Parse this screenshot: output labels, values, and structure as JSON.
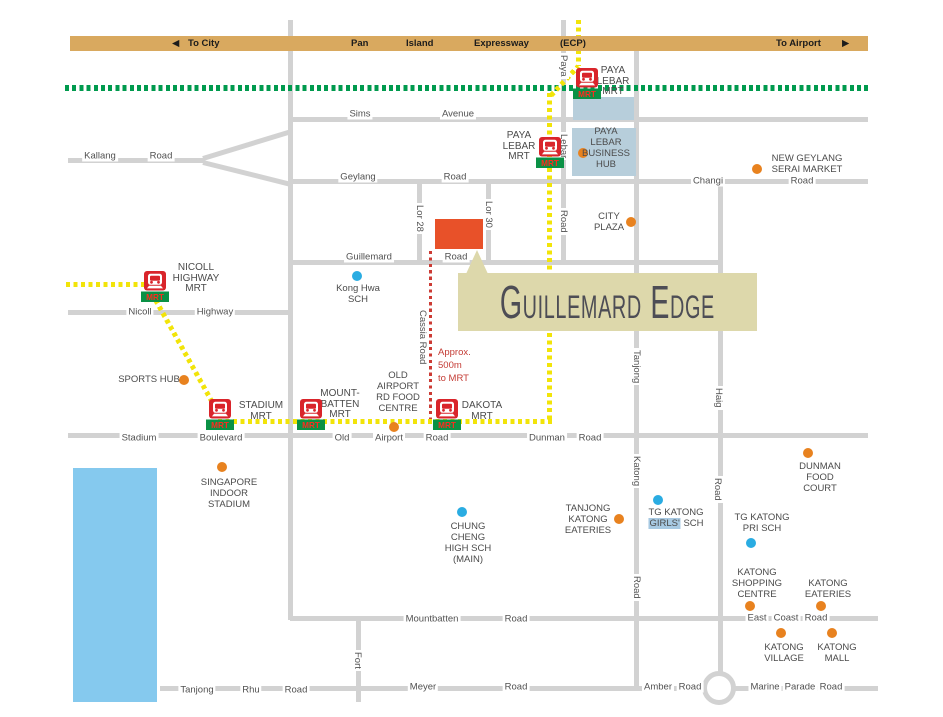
{
  "colors": {
    "road": "#d2d2d2",
    "band": "#d9a95f",
    "green_line": "#009a4e",
    "yellow_line": "#f2e409",
    "red_line": "#cc3b34",
    "amenity_dot": "#e8821f",
    "school_dot": "#2aace2",
    "site": "#e85129",
    "title_bg": "#ddd8ab",
    "title_text": "#4d4d55",
    "hub_block": "#b7cedb",
    "water": "#85c9ee",
    "highlight": "#a7c9e2",
    "mrt_red": "#d9252b",
    "mrt_green": "#0a9145"
  },
  "band": {
    "to_city_arrow": "◀",
    "to_city": "To City",
    "pan": "Pan",
    "island": "Island",
    "expressway": "Expressway",
    "ecp": "(ECP)",
    "to_airport": "To Airport",
    "to_airport_arrow": "▶"
  },
  "title_box": {
    "label": "Guillemard Edge"
  },
  "walk_note": {
    "lines": [
      "Approx.",
      "500m",
      "to MRT"
    ]
  },
  "roads": [
    {
      "name": "sims-avenue",
      "type": "h",
      "x": 292,
      "y": 119,
      "len": 576
    },
    {
      "name": "kallang-road",
      "type": "h",
      "x": 68,
      "y": 160,
      "len": 137
    },
    {
      "name": "geylang-changi-road",
      "type": "h",
      "x": 289,
      "y": 181,
      "len": 579
    },
    {
      "name": "guillemard-road",
      "type": "h",
      "x": 292,
      "y": 262,
      "len": 430
    },
    {
      "name": "nicoll-highway",
      "type": "h",
      "x": 68,
      "y": 312,
      "len": 224
    },
    {
      "name": "stadium-old-airport-dunman-road",
      "type": "h",
      "x": 68,
      "y": 435,
      "len": 800
    },
    {
      "name": "mountbatten-east-coast-road",
      "type": "h",
      "x": 290,
      "y": 618,
      "len": 588
    },
    {
      "name": "meyer-amber-marine-parade-road",
      "type": "h",
      "x": 160,
      "y": 688,
      "len": 718
    },
    {
      "name": "aljunied-road",
      "type": "v",
      "x": 290,
      "y": 20,
      "len": 600
    },
    {
      "name": "fort-road",
      "type": "v",
      "x": 358,
      "y": 618,
      "len": 84
    },
    {
      "name": "lorong-28",
      "type": "v",
      "x": 419,
      "y": 181,
      "len": 83
    },
    {
      "name": "lorong-30",
      "type": "v",
      "x": 488,
      "y": 181,
      "len": 83
    },
    {
      "name": "paya-lebar-road",
      "type": "v",
      "x": 563,
      "y": 20,
      "len": 244
    },
    {
      "name": "tanjong-katong-road",
      "type": "v",
      "x": 636,
      "y": 50,
      "len": 640
    },
    {
      "name": "haig-road",
      "type": "v",
      "x": 720,
      "y": 181,
      "len": 509
    },
    {
      "name": "kallang-fork-upper",
      "type": "d",
      "x": 203,
      "y": 158,
      "len": 92,
      "angle": -17
    },
    {
      "name": "kallang-fork-lower",
      "type": "d",
      "x": 203,
      "y": 162,
      "len": 90,
      "angle": 14
    }
  ],
  "transit": [
    {
      "name": "mrt-east-west-line",
      "color": "green",
      "type": "h",
      "x": 65,
      "y": 87,
      "len": 803
    },
    {
      "name": "mrt-circle-line-west",
      "color": "yellow",
      "type": "h",
      "x": 66,
      "y": 284,
      "len": 82
    },
    {
      "name": "mrt-circle-line-nicoll-stadium",
      "color": "yellow",
      "type": "d",
      "x": 152,
      "y": 293,
      "len": 130,
      "angle": 61
    },
    {
      "name": "mrt-circle-line-south",
      "color": "yellow",
      "type": "h",
      "x": 218,
      "y": 421,
      "len": 336
    },
    {
      "name": "mrt-line-paya-lebar-vertical",
      "color": "yellow",
      "type": "v",
      "x": 549,
      "y": 93,
      "len": 330
    },
    {
      "name": "mrt-line-paya-lebar-diagonal",
      "color": "yellow",
      "type": "d",
      "x": 551,
      "y": 95,
      "len": 40,
      "angle": -47
    },
    {
      "name": "mrt-line-top",
      "color": "yellow",
      "type": "v",
      "x": 578,
      "y": 20,
      "len": 46
    },
    {
      "name": "walking-route-cassia",
      "color": "red",
      "type": "v",
      "x": 431,
      "y": 251,
      "len": 168
    }
  ],
  "areas": [
    {
      "kind": "water",
      "name": "kallang-basin-water",
      "x": 73,
      "y": 468,
      "w": 84,
      "h": 234
    },
    {
      "kind": "hub",
      "name": "paya-lebar-business-hub-block-upper",
      "x": 573,
      "y": 97,
      "w": 61,
      "h": 23
    },
    {
      "kind": "hub",
      "name": "paya-lebar-business-hub-block-lower",
      "x": 572,
      "y": 128,
      "w": 64,
      "h": 48
    },
    {
      "kind": "site",
      "name": "guillemard-edge-site",
      "x": 435,
      "y": 219,
      "w": 48,
      "h": 30
    },
    {
      "kind": "roundabout",
      "name": "marine-parade-roundabout",
      "x": 702,
      "y": 671,
      "w": 34,
      "h": 34
    }
  ],
  "road_labels": [
    {
      "t": "Sims",
      "x": 360,
      "y": 114
    },
    {
      "t": "Avenue",
      "x": 458,
      "y": 114
    },
    {
      "t": "Kallang",
      "x": 100,
      "y": 156
    },
    {
      "t": "Road",
      "x": 161,
      "y": 156
    },
    {
      "t": "Geylang",
      "x": 358,
      "y": 177
    },
    {
      "t": "Road",
      "x": 455,
      "y": 177
    },
    {
      "t": "Changi",
      "x": 708,
      "y": 181
    },
    {
      "t": "Road",
      "x": 802,
      "y": 181
    },
    {
      "t": "Guillemard",
      "x": 369,
      "y": 257
    },
    {
      "t": "Road",
      "x": 456,
      "y": 257
    },
    {
      "t": "Nicoll",
      "x": 140,
      "y": 312
    },
    {
      "t": "Highway",
      "x": 215,
      "y": 312
    },
    {
      "t": "Stadium",
      "x": 139,
      "y": 438
    },
    {
      "t": "Boulevard",
      "x": 221,
      "y": 438
    },
    {
      "t": "Old",
      "x": 342,
      "y": 438
    },
    {
      "t": "Airport",
      "x": 389,
      "y": 438
    },
    {
      "t": "Road",
      "x": 437,
      "y": 438
    },
    {
      "t": "Dunman",
      "x": 547,
      "y": 438
    },
    {
      "t": "Road",
      "x": 590,
      "y": 438
    },
    {
      "t": "Mountbatten",
      "x": 432,
      "y": 619
    },
    {
      "t": "Road",
      "x": 516,
      "y": 619
    },
    {
      "t": "East",
      "x": 757,
      "y": 618
    },
    {
      "t": "Coast",
      "x": 786,
      "y": 618
    },
    {
      "t": "Road",
      "x": 816,
      "y": 618
    },
    {
      "t": "Meyer",
      "x": 423,
      "y": 687
    },
    {
      "t": "Road",
      "x": 516,
      "y": 687
    },
    {
      "t": "Tanjong",
      "x": 197,
      "y": 690
    },
    {
      "t": "Rhu",
      "x": 251,
      "y": 690
    },
    {
      "t": "Road",
      "x": 296,
      "y": 690
    },
    {
      "t": "Amber",
      "x": 658,
      "y": 687
    },
    {
      "t": "Road",
      "x": 690,
      "y": 687
    },
    {
      "t": "Marine",
      "x": 765,
      "y": 687
    },
    {
      "t": "Parade",
      "x": 800,
      "y": 687
    },
    {
      "t": "Road",
      "x": 831,
      "y": 687
    }
  ],
  "vertical_labels": [
    {
      "t": "Paya",
      "x": 558,
      "y": 53
    },
    {
      "t": "Lebar",
      "x": 558,
      "y": 132
    },
    {
      "t": "Road",
      "x": 558,
      "y": 208
    },
    {
      "t": "Lor 28",
      "x": 414,
      "y": 203
    },
    {
      "t": "Lor 30",
      "x": 483,
      "y": 199
    },
    {
      "t": "Cassia Road",
      "x": 417,
      "y": 308
    },
    {
      "t": "Tanjong",
      "x": 631,
      "y": 348
    },
    {
      "t": "Katong",
      "x": 631,
      "y": 454
    },
    {
      "t": "Road",
      "x": 631,
      "y": 574
    },
    {
      "t": "Haig",
      "x": 713,
      "y": 386
    },
    {
      "t": "Road",
      "x": 712,
      "y": 476
    },
    {
      "t": "Fort",
      "x": 352,
      "y": 650
    }
  ],
  "stations": [
    {
      "name": "paya-lebar-mrt-interchange",
      "icon_x": 587,
      "icon_y": 68,
      "label_x": 613,
      "label_y": 66,
      "lines": [
        "PAYA",
        "LEBAR",
        "MRT"
      ]
    },
    {
      "name": "paya-lebar-mrt",
      "icon_x": 550,
      "icon_y": 137,
      "label_x": 519,
      "label_y": 131,
      "lines": [
        "PAYA",
        "LEBAR",
        "MRT"
      ]
    },
    {
      "name": "nicoll-highway-mrt",
      "icon_x": 155,
      "icon_y": 271,
      "label_x": 196,
      "label_y": 263,
      "lines": [
        "NICOLL",
        "HIGHWAY",
        "MRT"
      ]
    },
    {
      "name": "stadium-mrt",
      "icon_x": 220,
      "icon_y": 399,
      "label_x": 261,
      "label_y": 401,
      "lines": [
        "STADIUM",
        "MRT"
      ]
    },
    {
      "name": "mountbatten-mrt",
      "icon_x": 311,
      "icon_y": 399,
      "label_x": 340,
      "label_y": 389,
      "lines": [
        "MOUNT-",
        "BATTEN",
        "MRT"
      ]
    },
    {
      "name": "dakota-mrt",
      "icon_x": 447,
      "icon_y": 399,
      "label_x": 482,
      "label_y": 401,
      "lines": [
        "DAKOTA",
        "MRT"
      ]
    }
  ],
  "pois": [
    {
      "kind": "amenity",
      "name": "sports-hub",
      "dot_x": 184,
      "dot_y": 380,
      "label_x": 149,
      "label_y": 374,
      "lines": [
        "SPORTS HUB"
      ]
    },
    {
      "kind": "amenity",
      "name": "old-airport-rd-food-centre",
      "dot_x": 394,
      "dot_y": 427,
      "label_x": 398,
      "label_y": 370,
      "lines": [
        "OLD",
        "AIRPORT",
        "RD FOOD",
        "CENTRE"
      ]
    },
    {
      "kind": "amenity",
      "name": "paya-lebar-business-hub",
      "dot_x": 583,
      "dot_y": 153,
      "label_x": 606,
      "label_y": 126,
      "lines": [
        "PAYA",
        "LEBAR",
        "BUSINESS",
        "HUB"
      ]
    },
    {
      "kind": "amenity",
      "name": "new-geylang-serai-market",
      "dot_x": 757,
      "dot_y": 169,
      "label_x": 807,
      "label_y": 153,
      "lines": [
        "NEW GEYLANG",
        "SERAI MARKET"
      ]
    },
    {
      "kind": "amenity",
      "name": "city-plaza",
      "dot_x": 631,
      "dot_y": 222,
      "label_x": 609,
      "label_y": 211,
      "lines": [
        "CITY",
        "PLAZA"
      ]
    },
    {
      "kind": "amenity",
      "name": "singapore-indoor-stadium",
      "dot_x": 222,
      "dot_y": 467,
      "label_x": 229,
      "label_y": 477,
      "lines": [
        "SINGAPORE",
        "INDOOR",
        "STADIUM"
      ]
    },
    {
      "kind": "amenity",
      "name": "tanjong-katong-eateries",
      "dot_x": 619,
      "dot_y": 519,
      "label_x": 588,
      "label_y": 503,
      "lines": [
        "TANJONG",
        "KATONG",
        "EATERIES"
      ]
    },
    {
      "kind": "amenity",
      "name": "dunman-food-court",
      "dot_x": 808,
      "dot_y": 453,
      "label_x": 820,
      "label_y": 461,
      "lines": [
        "DUNMAN",
        "FOOD",
        "COURT"
      ]
    },
    {
      "kind": "amenity",
      "name": "katong-shopping-centre",
      "dot_x": 750,
      "dot_y": 606,
      "label_x": 757,
      "label_y": 567,
      "lines": [
        "KATONG",
        "SHOPPING",
        "CENTRE"
      ]
    },
    {
      "kind": "amenity",
      "name": "katong-eateries",
      "dot_x": 821,
      "dot_y": 606,
      "label_x": 828,
      "label_y": 578,
      "lines": [
        "KATONG",
        "EATERIES"
      ]
    },
    {
      "kind": "amenity",
      "name": "katong-village",
      "dot_x": 781,
      "dot_y": 633,
      "label_x": 784,
      "label_y": 642,
      "lines": [
        "KATONG",
        "VILLAGE"
      ]
    },
    {
      "kind": "amenity",
      "name": "katong-mall",
      "dot_x": 832,
      "dot_y": 633,
      "label_x": 837,
      "label_y": 642,
      "lines": [
        "KATONG",
        "MALL"
      ]
    },
    {
      "kind": "school",
      "name": "kong-hwa-sch",
      "dot_x": 357,
      "dot_y": 276,
      "label_x": 358,
      "label_y": 283,
      "lines": [
        "Kong Hwa",
        "SCH"
      ]
    },
    {
      "kind": "school",
      "name": "chung-cheng-high-sch-main",
      "dot_x": 462,
      "dot_y": 512,
      "label_x": 468,
      "label_y": 521,
      "lines": [
        "CHUNG",
        "CHENG",
        "HIGH SCH",
        "(MAIN)"
      ]
    },
    {
      "kind": "school",
      "name": "tg-katong-girls-sch",
      "dot_x": 658,
      "dot_y": 500,
      "label_x": 676,
      "label_y": 507,
      "lines": [
        "TG KATONG",
        {
          "segments": [
            {
              "text": "GIRLS'",
              "highlight": true
            },
            {
              "text": " SCH",
              "highlight": false
            }
          ]
        }
      ]
    },
    {
      "kind": "school",
      "name": "tg-katong-pri-sch",
      "dot_x": 751,
      "dot_y": 543,
      "label_x": 762,
      "label_y": 512,
      "lines": [
        "TG KATONG",
        "PRI SCH"
      ]
    }
  ]
}
